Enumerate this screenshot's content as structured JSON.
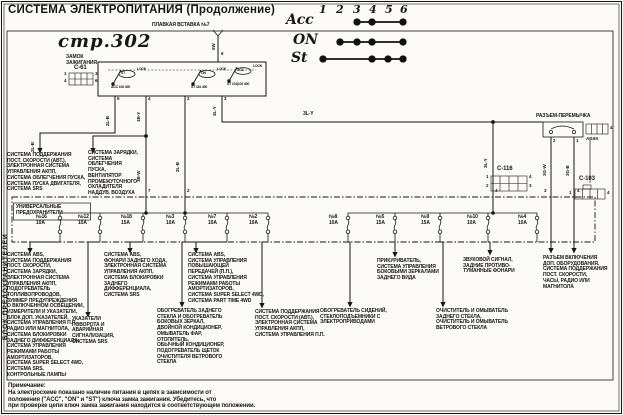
{
  "page": {
    "title": "СИСТЕМА ЭЛЕКТРОПИТАНИЯ (Продолжение)",
    "page_ref": "стр.302",
    "note_title": "Примечание:",
    "note_body": "На электросхеме показано наличие питания в цепях в зависимости от\nположения (\"ACC\", \"ON\" и \"ST\") ключа замка зажигания. Убедитесь, что\nпри проверке цепи ключ замка зажигания находится в соответствующем положении."
  },
  "key_table": {
    "cols": [
      "1",
      "2",
      "3",
      "4",
      "5",
      "6"
    ],
    "rows": [
      {
        "label": "Acc",
        "dots": [
          3,
          4,
          6
        ]
      },
      {
        "label": "ON",
        "dots": [
          2,
          3,
          4,
          6
        ]
      },
      {
        "label": "St",
        "dots": [
          1,
          4,
          5,
          6
        ]
      }
    ]
  },
  "top": {
    "fusible_link": "ПЛАВКАЯ ВСТАВКА №7",
    "wire_5w": "5W",
    "pin6": "6"
  },
  "ignition": {
    "name": "ЗАМОК\nЗАЖИГАНИЯ",
    "conn": "C-61",
    "c61_p1": "1",
    "c61_p3": "3",
    "c61_p4": "4",
    "c61_p6": "6",
    "sw1": "ST",
    "sw2": "ON",
    "sw3": "ACC",
    "lock": "LOCK",
    "sub1": "ACC 100 400",
    "sub2": "ST 181 400",
    "sub3": "ST 101|102 400",
    "pin5": "5",
    "pin4": "4",
    "pin2": "2",
    "pin3": "3"
  },
  "wires": {
    "w_2lb_a": "2L-B",
    "w_2lb_b": "2L-B",
    "w_1by": "1B-Y",
    "w_3bw": "3B-W",
    "w_2lb_c": "2L-B",
    "w_3ly_a": "3L-Y",
    "w_3ly_bus": "3L-Y",
    "w_3ly_b": "3L-Y",
    "w_3gw": "3G-W",
    "w_3gb": "3G-B",
    "pin7": "7",
    "pin2": "2",
    "pin4": "4",
    "jp2": "2",
    "jp1": "1",
    "jp3": "3",
    "jp4": "4"
  },
  "right": {
    "jumper": "РАЗЪЕМ-ПЕРЕМЫЧКА",
    "a19x": "A-19X",
    "a19x_pin": "4",
    "c116": "C-116",
    "c116_p1": "1",
    "c116_p4": "4",
    "c116_p2": "2",
    "c116_p3": "3",
    "c103": "C-103",
    "c103_p1": "1",
    "c103_p4": "4"
  },
  "fusebox": {
    "side": "БЛОК ПРЕДОХРАНИТЕЛЕЙ",
    "label": "УНИВЕРСАЛЬНЫЕ\nПРЕДОХРАНИТЕЛИ",
    "fuses": [
      {
        "no": "№16",
        "amp": "10A"
      },
      {
        "no": "№12",
        "amp": "10A"
      },
      {
        "no": "№18",
        "amp": "15A"
      },
      {
        "no": "№3",
        "amp": "10A"
      },
      {
        "no": "№7",
        "amp": "10A"
      },
      {
        "no": "№2",
        "amp": "10A"
      },
      {
        "no": "№8",
        "amp": "10A"
      },
      {
        "no": "№5",
        "amp": "15A"
      },
      {
        "no": "№9",
        "amp": "15A"
      },
      {
        "no": "№10",
        "amp": "10A"
      },
      {
        "no": "№4",
        "amp": "10A"
      }
    ]
  },
  "loads": {
    "a": "СИСТЕМА ПОДДЕРЖАНИЯ\nПОСТ. СКОРОСТИ (АВТ.),\nЭЛЕКТРОННАЯ СИСТЕМА\nУПРАВЛЕНИЯ АКПП,\nСИСТЕМА ОБЛЕГЧЕНИЯ ПУСКА,\nСИСТЕМА ПУСКА ДВИГАТЕЛЯ,\nСИСТЕМА SRS",
    "b": "СИСТЕМА ЗАРЯДКИ,\nСИСТЕМА\nОБЛЕГЧЕНИЯ\nПУСКА,\nВЕНТИЛЯТОР\nПРОМЕЖУТОЧНОГО\nОХЛАДИТЕЛЯ\nНАДДУВ. ВОЗДУХА",
    "f16": "СИСТЕМА ABS,\nСИСТЕМА ПОДДЕРЖАНИЯ\nПОСТ. СКОРОСТИ,\nСИСТЕМА ЗАРЯДКИ,\nЭЛЕКТРОННАЯ СИСТЕМА\nУПРАВЛЕНИЯ АКПП,\nПОДОГРЕВАТЕЛЬ\nТОПЛИВОПРОВОДОВ,\nЗУММЕР ПРЕДУПРЕЖДЕНИЯ\nО ВКЛЮЧЕННОМ ОСВЕЩЕНИИ,\nИЗМЕРИТЕЛИ И УКАЗАТЕЛИ,\nБЛОК ДОП. УКАЗАТЕЛЕЙ,\nСИСТЕМА УПРАВЛЕНИЯ П.П.,\nРАДИО ИЛИ МАГНИТОЛА,\nСИСТЕМА БЛОКИРОВКИ\nЗАДНЕГО ДИФФЕРЕНЦИАЛА,\nСИСТЕМА УПРАВЛЕНИЯ\nРЕЖИМАМИ РАБОТЫ\nАМОРТИЗАТОРОВ,\nСИСТЕМА SUPER SELECT 4WD,\nСИСТЕМА SRS,\nКОНТРОЛЬНЫЕ ЛАМПЫ",
    "f12": "УКАЗАТЕЛИ\nПОВОРОТА И\nАВАРИЙНАЯ\nСИГНАЛИЗАЦИЯ,\nСИСТЕМА SRS",
    "f18": "СИСТЕМА ABS,\nФОНАРИ ЗАДНЕГО ХОДА,\nЭЛЕКТРОННАЯ СИСТЕМА\nУПРАВЛЕНИЯ АКПП,\nСИСТЕМА БЛОКИРОВКИ\nЗАДНЕГО ДИФФЕРЕНЦИАЛА,\nСИСТЕМА SRS",
    "f3": "СИСТЕМА ABS,\nСИСТЕМА УПРАВЛЕНИЯ\nПОВЫШАЮЩЕЙ\nПЕРЕДАЧЕЙ (П.П.),\nСИСТЕМА УПРАВЛЕНИЯ\nРЕЖИМАМИ РАБОТЫ\nАМОРТИЗАТОРОВ,\nСИСТЕМА SUPER SELECT 4WD,\nСИСТЕМА PART TIME 4WD",
    "f7": "ОБОГРЕВАТЕЛЬ ЗАДНЕГО\nСТЕКЛА И ОБОГРЕВАТЕЛЬ\nБОКОВЫХ ЗЕРКАЛ,\nДВОЙНОЙ КОНДИЦИОНЕР,\nОМЫВАТЕЛЬ ФАР,\nОТОПИТЕЛЬ,\nОБЫЧНЫЙ КОНДИЦИОНЕР,\nПОДОГРЕВАТЕЛЬ ЩЕТОК\nОЧИСТИТЕЛЯ ВЕТРОВОГО\nСТЕКЛА",
    "f2": "СИСТЕМА ПОДДЕРЖАНИЯ\nПОСТ. СКОРОСТИ (АВТ.),\nЭЛЕКТРОННАЯ СИСТЕМА\nУПРАВЛЕНИЯ АКПП,\nСИСТЕМА УПРАВЛЕНИЯ П.П.",
    "f8": "ОБОГРЕВАТЕЛЬ СИДЕНИЙ,\nСТЕКЛОПОДЪЕМНИКИ С\nЭЛЕКТРОПРИВОДАМИ",
    "f5": "ПРИКУРИВАТЕЛЬ,\nСИСТЕМА УПРАВЛЕНИЯ\nБОКОВЫМИ ЗЕРКАЛАМИ\nЗАДНЕГО ВИДА",
    "f9": "ОЧИСТИТЕЛЬ И ОМЫВАТЕЛЬ\nЗАДНЕГО СТЕКЛА,\nОЧИСТИТЕЛЬ И ОМЫВАТЕЛЬ\nВЕТРОВОГО СТЕКЛА",
    "f10": "ЗВУКОВОЙ СИГНАЛ,\nЗАДНИЕ ПРОТИВО-\nТУМАННЫЕ ФОНАРИ",
    "f4": "РАЗЪЕМ ВКЛЮЧЕНИЯ\nДОП. ОБОРУДОВАНИЯ,\nСИСТЕМА ПОДДЕРЖАНИЯ\nПОСТ. СКОРОСТИ,\nЧАСЫ, РАДИО ИЛИ\nМАГНИТОЛА"
  }
}
